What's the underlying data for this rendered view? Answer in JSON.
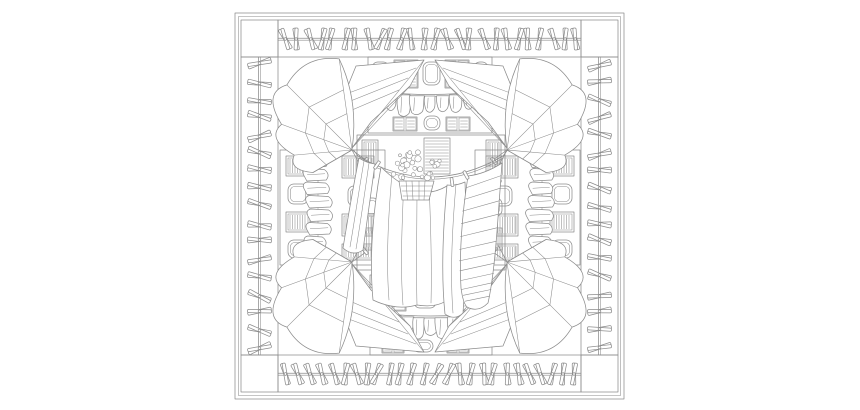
{
  "artwork": {
    "kind": "black-and-white line drawing",
    "description": "Square scarf-style line drawing of laundry day: borders of clothespins clipped on wires, building facades with louvered shutters, billowing pinned sheets in each corner, folded linens, and a sagging central clothesline with draped cloths and a basket of flowers",
    "background": "#ffffff",
    "ink": "#8c8c8c"
  },
  "canvas": {
    "width": 860,
    "height": 410
  },
  "frame": {
    "outer": [
      235,
      13,
      389,
      386
    ],
    "inner_offset": 3.5,
    "left": 241,
    "top": 20,
    "right": 618,
    "bottom": 392,
    "band": 37,
    "corner_cell": 37
  },
  "pins": {
    "top": 26,
    "bottom": 26,
    "left": 17,
    "right": 17,
    "seed": 20240601
  },
  "laundry": {
    "top_row_count": 9,
    "bottom_row_count": 9
  },
  "stacks": {
    "count": 8
  },
  "garland": {
    "flower_count": 34
  }
}
